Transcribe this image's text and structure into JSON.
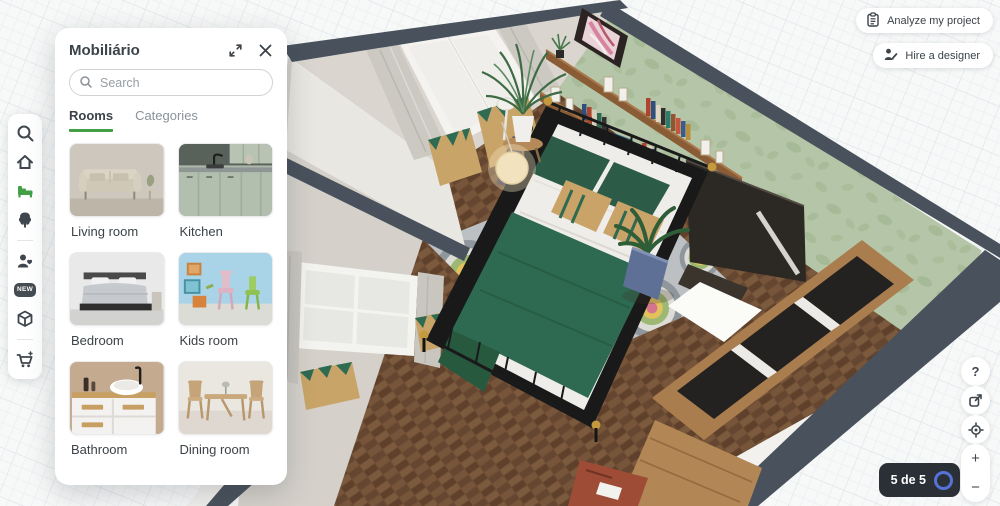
{
  "panel": {
    "title": "Mobiliário",
    "search_placeholder": "Search",
    "tabs": [
      {
        "label": "Rooms"
      },
      {
        "label": "Categories"
      }
    ],
    "active_tab": "Rooms",
    "rooms": [
      {
        "label": "Living room"
      },
      {
        "label": "Kitchen"
      },
      {
        "label": "Bedroom"
      },
      {
        "label": "Kids room"
      },
      {
        "label": "Bathroom"
      },
      {
        "label": "Dining room"
      }
    ]
  },
  "sidebar": {
    "new_badge": "NEW",
    "items": [
      "search",
      "home",
      "furniture",
      "plants",
      "people",
      "new",
      "objects",
      "cart"
    ],
    "active_item": "furniture"
  },
  "top_actions": {
    "analyze": "Analyze my project",
    "hire": "Hire a designer"
  },
  "view_controls": {
    "help": "?",
    "zoom_in": "+",
    "zoom_out": "−"
  },
  "status_badge": {
    "text": "5 de 5"
  },
  "colors": {
    "accent_green": "#43a047",
    "badge_bg": "#2b3037",
    "ring_blue": "#5572d8",
    "wall_cap": "#49525c",
    "wallpaper_green": "#b5c6a8",
    "floor_brown": "#6f4e35"
  }
}
